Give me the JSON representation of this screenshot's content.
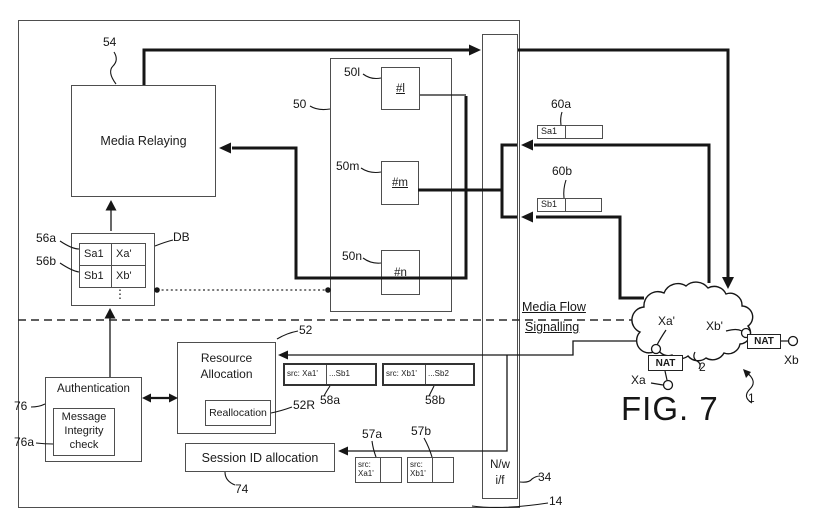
{
  "figure_label": "FIG. 7",
  "server": {
    "media_relaying": "Media Relaying",
    "sockets": {
      "l": "#l",
      "m": "#m",
      "n": "#n"
    },
    "db": {
      "rows": [
        [
          "Sa1",
          "Xa'"
        ],
        [
          "Sb1",
          "Xb'"
        ]
      ],
      "more": "⋮"
    },
    "resource_allocation": "Resource Allocation",
    "reallocation": "Reallocation",
    "session_id_allocation": "Session ID allocation",
    "authentication": "Authentication",
    "message_integrity_check": "Message Integrity check",
    "network_interface": {
      "line1": "N/w",
      "line2": "i/f"
    }
  },
  "messages": {
    "m60a": {
      "tag": "Sa1"
    },
    "m60b": {
      "tag": "Sb1"
    },
    "m58a": {
      "src": "src: Xa1'",
      "dst": "...Sb1"
    },
    "m58b": {
      "src": "src: Xb1'",
      "dst": "...Sb2"
    },
    "m57a": {
      "src": "src: Xa1'"
    },
    "m57b": {
      "src": "src: Xb1'"
    }
  },
  "planes": {
    "media_flow": "Media Flow",
    "signalling": "Signalling"
  },
  "external": {
    "nat_a": "NAT",
    "nat_b": "NAT",
    "xa_prime": "Xa'",
    "xb_prime": "Xb'",
    "xa": "Xa",
    "xb": "Xb"
  },
  "refs": {
    "n1": "1",
    "n2": "2",
    "n14": "14",
    "n34": "34",
    "n50": "50",
    "n50l": "50l",
    "n50m": "50m",
    "n50n": "50n",
    "n52": "52",
    "n52R": "52R",
    "n54": "54",
    "n56a": "56a",
    "n56b": "56b",
    "n57a": "57a",
    "n57b": "57b",
    "n58a": "58a",
    "n58b": "58b",
    "n60a": "60a",
    "n60b": "60b",
    "n74": "74",
    "n76": "76",
    "n76a": "76a"
  },
  "colors": {
    "line": "#161616",
    "border": "#4e4e4e",
    "background": "#ffffff"
  }
}
